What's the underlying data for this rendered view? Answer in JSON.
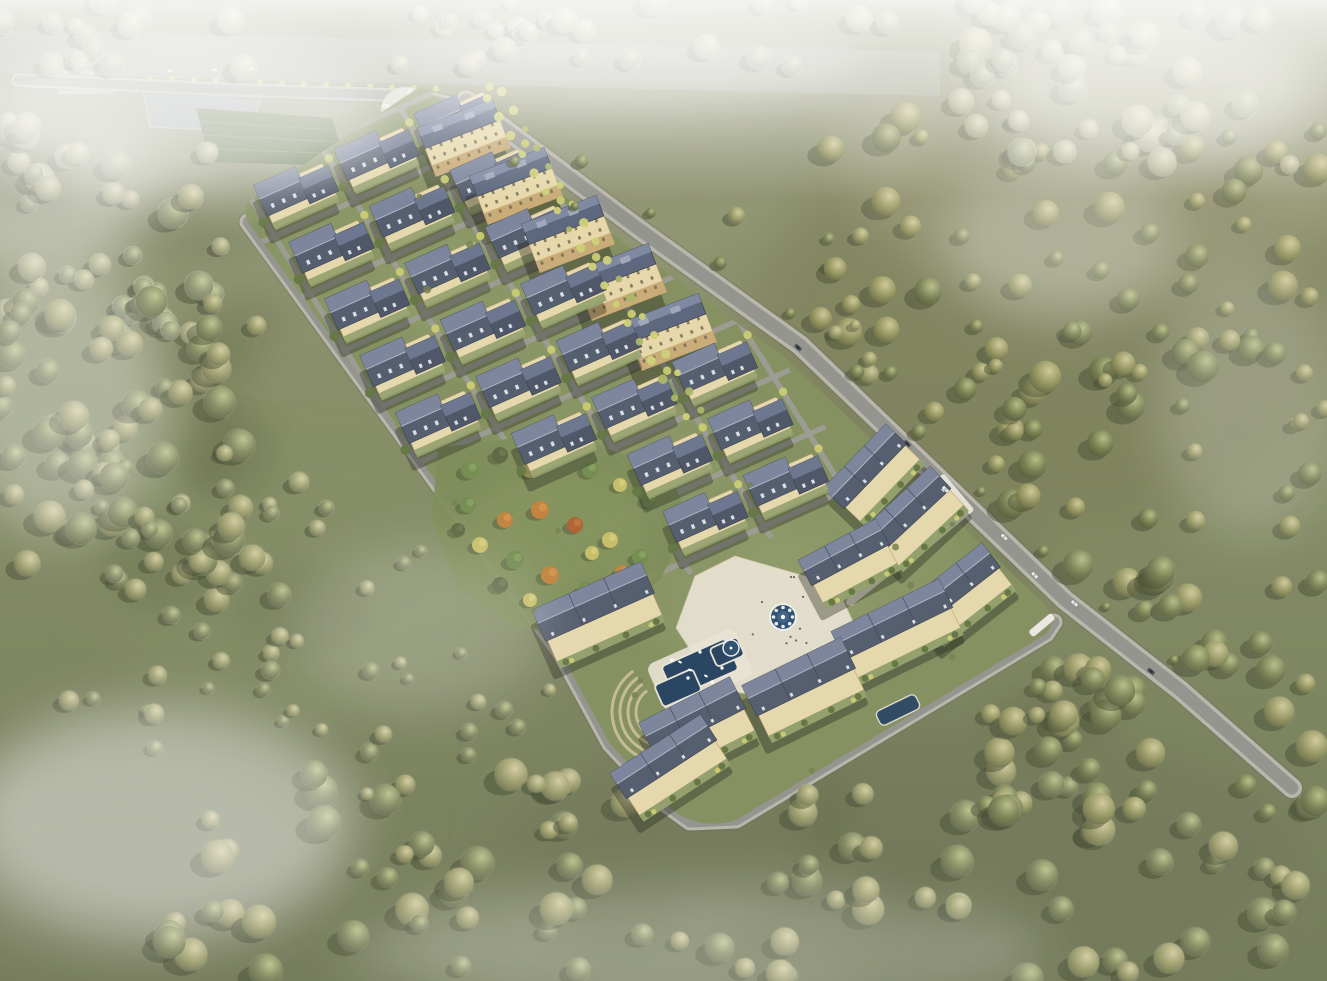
{
  "meta": {
    "description": "Hazy bird's-eye architectural rendering of a planned residential community: diagonal site strip of slate-roofed townhouse rows and mid-rise apartment slabs, central autumn park, plaza with round fountain and pools, perimeter roads with cars, surrounded by olive-green fields and misty woodland",
    "style": "architectural-visualization"
  },
  "palette": {
    "fieldTop": "#909170",
    "fieldMid": "#7e865d",
    "fieldBottom": "#6d7551",
    "patchDark": "#555c39",
    "shadeLight": "#8d9472",
    "treeShadow": "#3a4026",
    "treeOlive": "#8a8f57",
    "treeYellow": "#c6c868",
    "treeBright": "#ccd06f",
    "roadAsphalt": "#8e8e88",
    "roadSidewalk": "#b5b2a7",
    "roadCasing": "#62625a",
    "sitePlate": "#7d8a57",
    "siteLawn": "#93a068",
    "garden": "#8d9a64",
    "roofDark": "#4b5466",
    "roofDarker": "#434c5f",
    "roofLight": "#7c86a0",
    "roofPale": "#a9b2c2",
    "dormer": "#d9dee6",
    "wallCream": "#e5d7a8",
    "wallTan": "#bc9d69",
    "wallBase": "#c2a268",
    "windowDark": "#6b6048",
    "parkGreen": "#77874f",
    "plaza": "#e7e1cf",
    "plazaEdge": "#cfc6a9",
    "amphi": "#cfbf97",
    "poolWater": "#1c3a58",
    "fountainWater": "#24466b",
    "pondWater": "#9aa7a9",
    "riverWater": "#a9b2b1",
    "terraceGreen": "#54683c",
    "white": "#f2f3f0",
    "carDark": "#3c4048",
    "mist": "#f4f4f1",
    "sun": "#fff6e0"
  },
  "scene": {
    "canvas": {
      "w": 1327,
      "h": 981
    },
    "site": {
      "outline": "M 430,92 L 452,110 L 626,244 L 786,358 L 916,482 L 1044,604 Q 1058,620 1046,634 L 736,820 Q 698,832 668,806 L 610,744 L 560,652 L 248,222 Q 240,206 256,196 L 418,88 Q 428,86 430,92 Z",
      "poly": [
        [
          430,
          92
        ],
        [
          452,
          110
        ],
        [
          626,
          244
        ],
        [
          786,
          358
        ],
        [
          916,
          482
        ],
        [
          1044,
          604
        ],
        [
          1058,
          620
        ],
        [
          1046,
          634
        ],
        [
          736,
          820
        ],
        [
          698,
          832
        ],
        [
          668,
          806
        ],
        [
          610,
          744
        ],
        [
          560,
          652
        ],
        [
          248,
          222
        ],
        [
          240,
          206
        ],
        [
          256,
          196
        ],
        [
          418,
          88
        ]
      ]
    },
    "grid": {
      "origin": [
        297,
        190
      ],
      "du": [
        80.4,
        -35.8
      ],
      "dv": [
        35.5,
        56.8
      ],
      "cols": 4,
      "rows": 8,
      "angle": -24,
      "skips": [
        [
          3,
          0
        ],
        [
          3,
          1
        ],
        [
          3,
          2
        ],
        [
          3,
          3
        ],
        [
          3,
          4
        ],
        [
          0,
          5
        ],
        [
          0,
          6
        ],
        [
          0,
          7
        ],
        [
          1,
          6
        ],
        [
          1,
          7
        ]
      ]
    },
    "apartments": {
      "angle": -21,
      "centers": [
        [
          464,
          138
        ],
        [
          516,
          186
        ],
        [
          568,
          234
        ],
        [
          620,
          282
        ],
        [
          670,
          332
        ]
      ]
    },
    "rowhouses": [
      [
        600,
        617,
        115,
        52,
        -24
      ],
      [
        700,
        731,
        98,
        54,
        -27
      ],
      [
        806,
        692,
        106,
        52,
        -26
      ],
      [
        899,
        634,
        116,
        48,
        -26
      ],
      [
        963,
        597,
        92,
        46,
        -38
      ],
      [
        917,
        521,
        90,
        46,
        -43
      ],
      [
        876,
        477,
        86,
        44,
        -46
      ],
      [
        672,
        770,
        104,
        46,
        -33
      ],
      [
        851,
        566,
        84,
        44,
        -28
      ]
    ],
    "roads": {
      "main": [
        [
          466,
          100
        ],
        [
          640,
          230
        ],
        [
          800,
          345
        ],
        [
          930,
          470
        ],
        [
          1065,
          600
        ],
        [
          1180,
          690
        ],
        [
          1292,
          788
        ]
      ],
      "top": [
        [
          18,
          80
        ],
        [
          240,
          90
        ],
        [
          418,
          96
        ],
        [
          452,
          104
        ]
      ],
      "perimeter": [
        [
          248,
          222
        ],
        [
          560,
          652
        ],
        [
          610,
          744
        ],
        [
          668,
          806
        ],
        [
          690,
          822
        ],
        [
          736,
          820
        ],
        [
          1046,
          634
        ],
        [
          1054,
          622
        ]
      ]
    },
    "circular_plaza": {
      "c": [
        405,
        111
      ],
      "r": 24
    },
    "pond": [
      [
        142,
        88
      ],
      [
        262,
        93
      ],
      [
        252,
        132
      ],
      [
        150,
        127
      ]
    ],
    "river": [
      [
        0,
        30
      ],
      [
        940,
        52
      ],
      [
        940,
        96
      ],
      [
        0,
        74
      ]
    ],
    "terraces": [
      [
        196,
        108
      ],
      [
        332,
        118
      ],
      [
        346,
        166
      ],
      [
        210,
        162
      ]
    ],
    "community_building": {
      "x": 58,
      "y": 70,
      "w": 58,
      "h": 24
    },
    "park": {
      "blob": [
        [
          438,
          448
        ],
        [
          560,
          432
        ],
        [
          668,
          470
        ],
        [
          690,
          520
        ],
        [
          660,
          580
        ],
        [
          600,
          628
        ],
        [
          520,
          630
        ],
        [
          458,
          588
        ],
        [
          432,
          520
        ]
      ],
      "trees": [
        [
          470,
          470,
          "g",
          9
        ],
        [
          500,
          455,
          "d",
          8
        ],
        [
          530,
          470,
          "y",
          8
        ],
        [
          560,
          455,
          "g",
          7
        ],
        [
          590,
          470,
          "g",
          8
        ],
        [
          620,
          485,
          "y",
          7
        ],
        [
          650,
          500,
          "g",
          8
        ],
        [
          468,
          505,
          "g",
          8
        ],
        [
          505,
          520,
          "o",
          8
        ],
        [
          540,
          510,
          "o",
          9
        ],
        [
          575,
          525,
          "r",
          8
        ],
        [
          610,
          540,
          "y",
          8
        ],
        [
          640,
          557,
          "g",
          8
        ],
        [
          480,
          545,
          "y",
          8
        ],
        [
          515,
          560,
          "g",
          9
        ],
        [
          550,
          575,
          "o",
          9
        ],
        [
          585,
          590,
          "g",
          8
        ],
        [
          615,
          600,
          "d",
          7
        ],
        [
          500,
          585,
          "d",
          8
        ],
        [
          530,
          600,
          "y",
          7
        ],
        [
          562,
          615,
          "g",
          7
        ],
        [
          458,
          530,
          "d",
          7
        ],
        [
          622,
          572,
          "o",
          7
        ],
        [
          592,
          553,
          "y",
          7
        ]
      ]
    },
    "plaza": {
      "poly": [
        [
          735,
          556
        ],
        [
          836,
          585
        ],
        [
          862,
          641
        ],
        [
          806,
          703
        ],
        [
          716,
          689
        ],
        [
          676,
          628
        ],
        [
          695,
          576
        ]
      ],
      "fountain": {
        "c": [
          783,
          617
        ],
        "r": 13
      },
      "fountain2": {
        "c": [
          731,
          648
        ],
        "r": 8
      },
      "walk": [
        [
          850,
          602
        ],
        [
          912,
          552
        ],
        [
          948,
          522
        ]
      ]
    },
    "pools": {
      "deck": [
        700,
        670,
        96,
        52,
        -24
      ],
      "basins": [
        [
          700,
          668,
          70,
          34
        ],
        [
          678,
          688,
          42,
          24
        ],
        [
          727,
          652,
          30,
          20
        ]
      ],
      "jets": [
        [
          672,
          660
        ],
        [
          700,
          652
        ],
        [
          722,
          668
        ],
        [
          688,
          678
        ],
        [
          712,
          682
        ]
      ],
      "boats": [
        [
          690,
          670
        ],
        [
          706,
          676
        ],
        [
          680,
          662
        ]
      ],
      "pond_small": [
        898,
        710,
        44,
        16,
        -26
      ]
    },
    "amphitheater": {
      "c": [
        662,
        712
      ],
      "radii": [
        26,
        34,
        42,
        50
      ]
    },
    "entrance": {
      "plaza": [
        930,
        516,
        76,
        48,
        -40
      ],
      "gate": [
        936,
        510,
        26,
        14,
        -42
      ],
      "road_gate": [
        1042,
        625,
        30,
        8,
        -40
      ]
    },
    "forest_regions": [
      {
        "x": 820,
        "y": 110,
        "w": 507,
        "h": 420,
        "n": 95,
        "rmin": 7,
        "rmax": 16,
        "seed": 11,
        "haze": 0
      },
      {
        "x": 950,
        "y": 0,
        "w": 377,
        "h": 170,
        "n": 45,
        "rmin": 8,
        "rmax": 16,
        "seed": 12,
        "haze": 0.5
      },
      {
        "x": 0,
        "y": 120,
        "w": 230,
        "h": 220,
        "n": 40,
        "rmin": 8,
        "rmax": 15,
        "seed": 13,
        "haze": 0.45
      },
      {
        "x": 0,
        "y": 300,
        "w": 280,
        "h": 300,
        "n": 68,
        "rmin": 8,
        "rmax": 16,
        "seed": 14,
        "haze": 0.22
      },
      {
        "x": 150,
        "y": 770,
        "w": 1177,
        "h": 211,
        "n": 95,
        "rmin": 8,
        "rmax": 17,
        "seed": 15,
        "haze": 0.2
      },
      {
        "x": 950,
        "y": 560,
        "w": 377,
        "h": 260,
        "n": 70,
        "rmin": 8,
        "rmax": 16,
        "seed": 16,
        "haze": 0.08
      },
      {
        "x": 60,
        "y": 470,
        "w": 380,
        "h": 300,
        "n": 30,
        "rmin": 5,
        "rmax": 10,
        "seed": 17,
        "haze": 0.3
      },
      {
        "x": 700,
        "y": 180,
        "w": 180,
        "h": 280,
        "n": 22,
        "rmin": 5,
        "rmax": 10,
        "seed": 18,
        "haze": 0.12
      },
      {
        "x": 0,
        "y": 0,
        "w": 900,
        "h": 70,
        "n": 40,
        "rmin": 7,
        "rmax": 13,
        "seed": 19,
        "haze": 0.6
      },
      {
        "x": 230,
        "y": 640,
        "w": 330,
        "h": 160,
        "n": 18,
        "rmin": 5,
        "rmax": 9,
        "seed": 20,
        "haze": 0.25
      }
    ],
    "field_shades": [
      [
        200,
        150,
        500,
        260,
        "#8d9472",
        0.5
      ],
      [
        1050,
        330,
        600,
        400,
        "#6f7048",
        0.45
      ],
      [
        300,
        560,
        420,
        300,
        "#7f8a5e",
        0.5
      ],
      [
        900,
        850,
        800,
        260,
        "#676e4e",
        0.5
      ],
      [
        120,
        860,
        400,
        200,
        "#8b8e74",
        0.5
      ],
      [
        620,
        180,
        360,
        160,
        "#8f9572",
        0.4
      ]
    ],
    "mist": [
      [
        180,
        110,
        420,
        170,
        0.6
      ],
      [
        620,
        60,
        500,
        95,
        0.5
      ],
      [
        1150,
        90,
        330,
        150,
        0.5
      ],
      [
        60,
        400,
        210,
        270,
        0.38
      ],
      [
        160,
        820,
        390,
        230,
        0.45
      ],
      [
        700,
        950,
        700,
        130,
        0.28
      ],
      [
        1250,
        400,
        190,
        270,
        0.22
      ],
      [
        420,
        630,
        260,
        170,
        0.2
      ],
      [
        1060,
        240,
        230,
        170,
        0.28
      ],
      [
        30,
        180,
        260,
        200,
        0.45
      ]
    ],
    "sun_glow": [
      1100,
      150,
      520,
      300,
      0.16
    ],
    "cars": {
      "main": [
        [
          0.385,
          "d"
        ],
        [
          0.52,
          "d"
        ],
        [
          0.575,
          "w"
        ],
        [
          0.645,
          "w"
        ],
        [
          0.69,
          "w"
        ],
        [
          0.735,
          "w"
        ],
        [
          0.83,
          "d"
        ]
      ],
      "top": [
        [
          170,
          71
        ],
        [
          215,
          70
        ],
        [
          252,
          69
        ]
      ]
    },
    "street_trees": {
      "avenue": {
        "i": 2.5,
        "j0": -0.1,
        "j1": 5.6,
        "step": 0.33
      },
      "verge_t": [
        0.12,
        0.2,
        0.28,
        0.36,
        0.44,
        0.52,
        0.6,
        0.68,
        0.76,
        0.84
      ],
      "sw_t": [
        0.07,
        0.14
      ]
    }
  }
}
